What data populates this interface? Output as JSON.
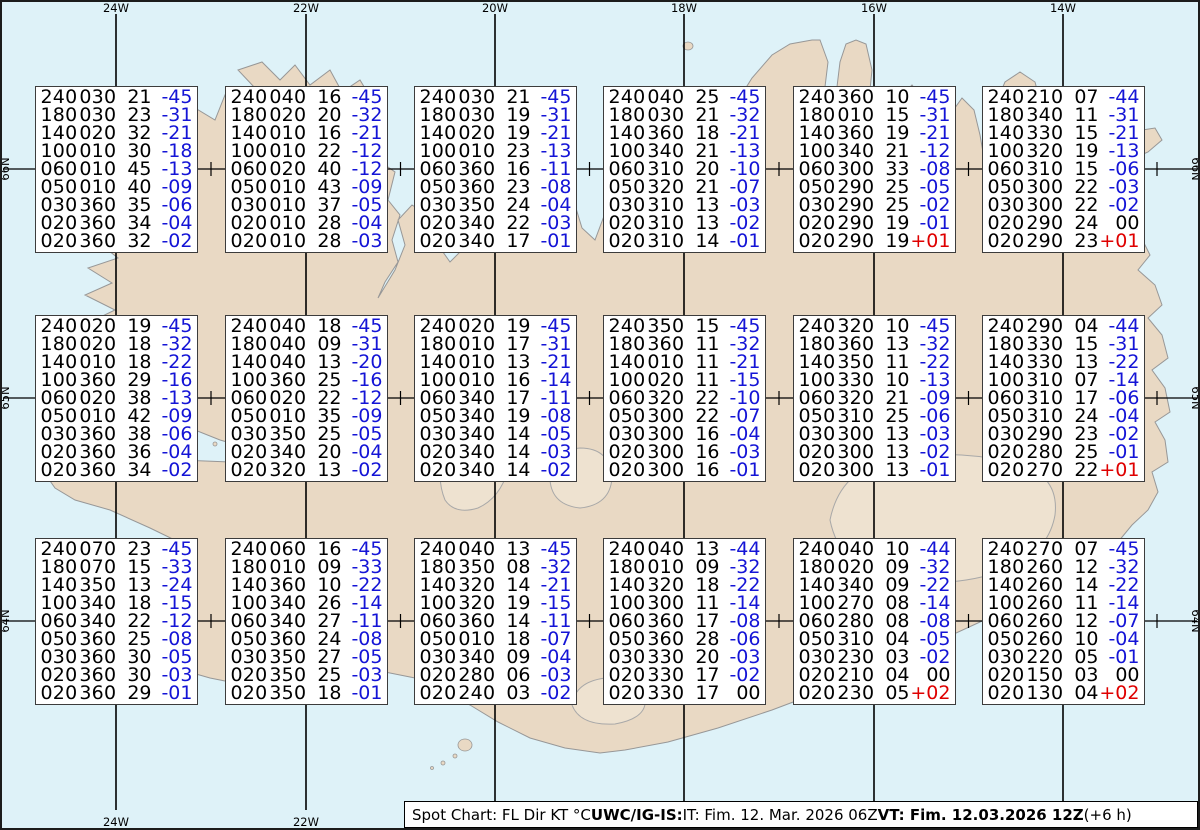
{
  "chart_title": "Spot Chart Iceland upper winds and temperatures",
  "colors": {
    "ocean": "#def2f8",
    "land": "#e9d9c4",
    "coast": "#979797",
    "glacier_line": "#a8a8a8",
    "grid": "#000000",
    "temp_negative": "#1414d6",
    "temp_positive": "#df0000",
    "temp_zero": "#000000",
    "box_background": "#ffffff",
    "box_border": "#3c3c3c"
  },
  "grid": {
    "meridians": [
      {
        "label": "24W",
        "x": 116
      },
      {
        "label": "22W",
        "x": 306
      },
      {
        "label": "20W",
        "x": 495
      },
      {
        "label": "18W",
        "x": 684
      },
      {
        "label": "16W",
        "x": 874
      },
      {
        "label": "14W",
        "x": 1063
      }
    ],
    "parallels": [
      {
        "label": "66N",
        "y": 169
      },
      {
        "label": "65N",
        "y": 398
      },
      {
        "label": "64N",
        "y": 621
      }
    ]
  },
  "caption": {
    "segments": [
      {
        "text": "Spot Chart: FL Dir KT °C ",
        "bold": false
      },
      {
        "text": "UWC/IG-IS:",
        "bold": true
      },
      {
        "text": " IT: Fim. 12. Mar. 2026 06Z ",
        "bold": false
      },
      {
        "text": "VT: Fim. 12.03.2026 12Z",
        "bold": true
      },
      {
        "text": " (+6 h)",
        "bold": false
      }
    ]
  },
  "boxes": [
    {
      "r": 0,
      "c": 0,
      "lines": [
        [
          "240030",
          "21",
          "-45"
        ],
        [
          "180030",
          "23",
          "-31"
        ],
        [
          "140020",
          "32",
          "-21"
        ],
        [
          "100010",
          "30",
          "-18"
        ],
        [
          "060010",
          "45",
          "-13"
        ],
        [
          "050010",
          "40",
          "-09"
        ],
        [
          "030360",
          "35",
          "-06"
        ],
        [
          "020360",
          "34",
          "-04"
        ],
        [
          "020360",
          "32",
          "-02"
        ]
      ]
    },
    {
      "r": 0,
      "c": 1,
      "lines": [
        [
          "240040",
          "16",
          "-45"
        ],
        [
          "180020",
          "20",
          "-32"
        ],
        [
          "140010",
          "16",
          "-21"
        ],
        [
          "100010",
          "22",
          "-12"
        ],
        [
          "060020",
          "40",
          "-12"
        ],
        [
          "050010",
          "43",
          "-09"
        ],
        [
          "030010",
          "37",
          "-05"
        ],
        [
          "020010",
          "28",
          "-04"
        ],
        [
          "020010",
          "28",
          "-03"
        ]
      ]
    },
    {
      "r": 0,
      "c": 2,
      "lines": [
        [
          "240030",
          "21",
          "-45"
        ],
        [
          "180030",
          "19",
          "-31"
        ],
        [
          "140020",
          "19",
          "-21"
        ],
        [
          "100010",
          "23",
          "-13"
        ],
        [
          "060360",
          "16",
          "-11"
        ],
        [
          "050360",
          "23",
          "-08"
        ],
        [
          "030350",
          "24",
          "-04"
        ],
        [
          "020340",
          "22",
          "-03"
        ],
        [
          "020340",
          "17",
          "-01"
        ]
      ]
    },
    {
      "r": 0,
      "c": 3,
      "lines": [
        [
          "240040",
          "25",
          "-45"
        ],
        [
          "180030",
          "21",
          "-32"
        ],
        [
          "140360",
          "18",
          "-21"
        ],
        [
          "100340",
          "21",
          "-13"
        ],
        [
          "060310",
          "20",
          "-10"
        ],
        [
          "050320",
          "21",
          "-07"
        ],
        [
          "030310",
          "13",
          "-03"
        ],
        [
          "020310",
          "13",
          "-02"
        ],
        [
          "020310",
          "14",
          "-01"
        ]
      ]
    },
    {
      "r": 0,
      "c": 4,
      "lines": [
        [
          "240360",
          "10",
          "-45"
        ],
        [
          "180010",
          "15",
          "-31"
        ],
        [
          "140360",
          "19",
          "-21"
        ],
        [
          "100340",
          "21",
          "-12"
        ],
        [
          "060300",
          "33",
          "-08"
        ],
        [
          "050290",
          "25",
          "-05"
        ],
        [
          "030290",
          "25",
          "-02"
        ],
        [
          "020290",
          "19",
          "-01"
        ],
        [
          "020290",
          "19",
          "+01"
        ]
      ]
    },
    {
      "r": 0,
      "c": 5,
      "lines": [
        [
          "240210",
          "07",
          "-44"
        ],
        [
          "180340",
          "11",
          "-31"
        ],
        [
          "140330",
          "15",
          "-21"
        ],
        [
          "100320",
          "19",
          "-13"
        ],
        [
          "060310",
          "15",
          "-06"
        ],
        [
          "050300",
          "22",
          "-03"
        ],
        [
          "030300",
          "22",
          "-02"
        ],
        [
          "020290",
          "24",
          "00"
        ],
        [
          "020290",
          "23",
          "+01"
        ]
      ]
    },
    {
      "r": 1,
      "c": 0,
      "lines": [
        [
          "240020",
          "19",
          "-45"
        ],
        [
          "180020",
          "18",
          "-32"
        ],
        [
          "140010",
          "18",
          "-22"
        ],
        [
          "100360",
          "29",
          "-16"
        ],
        [
          "060020",
          "38",
          "-13"
        ],
        [
          "050010",
          "42",
          "-09"
        ],
        [
          "030360",
          "38",
          "-06"
        ],
        [
          "020360",
          "36",
          "-04"
        ],
        [
          "020360",
          "34",
          "-02"
        ]
      ]
    },
    {
      "r": 1,
      "c": 1,
      "lines": [
        [
          "240040",
          "18",
          "-45"
        ],
        [
          "180040",
          "09",
          "-31"
        ],
        [
          "140040",
          "13",
          "-20"
        ],
        [
          "100360",
          "25",
          "-16"
        ],
        [
          "060020",
          "22",
          "-12"
        ],
        [
          "050010",
          "35",
          "-09"
        ],
        [
          "030350",
          "25",
          "-05"
        ],
        [
          "020340",
          "20",
          "-04"
        ],
        [
          "020320",
          "13",
          "-02"
        ]
      ]
    },
    {
      "r": 1,
      "c": 2,
      "lines": [
        [
          "240020",
          "19",
          "-45"
        ],
        [
          "180010",
          "17",
          "-31"
        ],
        [
          "140010",
          "13",
          "-21"
        ],
        [
          "100010",
          "16",
          "-14"
        ],
        [
          "060340",
          "17",
          "-11"
        ],
        [
          "050340",
          "19",
          "-08"
        ],
        [
          "030340",
          "14",
          "-05"
        ],
        [
          "020340",
          "14",
          "-03"
        ],
        [
          "020340",
          "14",
          "-02"
        ]
      ]
    },
    {
      "r": 1,
      "c": 3,
      "lines": [
        [
          "240350",
          "15",
          "-45"
        ],
        [
          "180360",
          "11",
          "-32"
        ],
        [
          "140010",
          "11",
          "-21"
        ],
        [
          "100020",
          "11",
          "-15"
        ],
        [
          "060320",
          "22",
          "-10"
        ],
        [
          "050300",
          "22",
          "-07"
        ],
        [
          "030300",
          "16",
          "-04"
        ],
        [
          "020300",
          "16",
          "-03"
        ],
        [
          "020300",
          "16",
          "-01"
        ]
      ]
    },
    {
      "r": 1,
      "c": 4,
      "lines": [
        [
          "240320",
          "10",
          "-45"
        ],
        [
          "180360",
          "13",
          "-32"
        ],
        [
          "140350",
          "11",
          "-22"
        ],
        [
          "100330",
          "10",
          "-13"
        ],
        [
          "060320",
          "21",
          "-09"
        ],
        [
          "050310",
          "25",
          "-06"
        ],
        [
          "030300",
          "13",
          "-03"
        ],
        [
          "020300",
          "13",
          "-02"
        ],
        [
          "020300",
          "13",
          "-01"
        ]
      ]
    },
    {
      "r": 1,
      "c": 5,
      "lines": [
        [
          "240290",
          "04",
          "-44"
        ],
        [
          "180330",
          "15",
          "-31"
        ],
        [
          "140330",
          "13",
          "-22"
        ],
        [
          "100310",
          "07",
          "-14"
        ],
        [
          "060310",
          "17",
          "-06"
        ],
        [
          "050310",
          "24",
          "-04"
        ],
        [
          "030290",
          "23",
          "-02"
        ],
        [
          "020280",
          "25",
          "-01"
        ],
        [
          "020270",
          "22",
          "+01"
        ]
      ]
    },
    {
      "r": 2,
      "c": 0,
      "lines": [
        [
          "240070",
          "23",
          "-45"
        ],
        [
          "180070",
          "15",
          "-33"
        ],
        [
          "140350",
          "13",
          "-24"
        ],
        [
          "100340",
          "18",
          "-15"
        ],
        [
          "060340",
          "22",
          "-12"
        ],
        [
          "050360",
          "25",
          "-08"
        ],
        [
          "030360",
          "30",
          "-05"
        ],
        [
          "020360",
          "30",
          "-03"
        ],
        [
          "020360",
          "29",
          "-01"
        ]
      ]
    },
    {
      "r": 2,
      "c": 1,
      "lines": [
        [
          "240060",
          "16",
          "-45"
        ],
        [
          "180010",
          "09",
          "-33"
        ],
        [
          "140360",
          "10",
          "-22"
        ],
        [
          "100340",
          "26",
          "-14"
        ],
        [
          "060340",
          "27",
          "-11"
        ],
        [
          "050360",
          "24",
          "-08"
        ],
        [
          "030350",
          "27",
          "-05"
        ],
        [
          "020350",
          "25",
          "-03"
        ],
        [
          "020350",
          "18",
          "-01"
        ]
      ]
    },
    {
      "r": 2,
      "c": 2,
      "lines": [
        [
          "240040",
          "13",
          "-45"
        ],
        [
          "180350",
          "08",
          "-32"
        ],
        [
          "140320",
          "14",
          "-21"
        ],
        [
          "100320",
          "19",
          "-15"
        ],
        [
          "060360",
          "14",
          "-11"
        ],
        [
          "050010",
          "18",
          "-07"
        ],
        [
          "030340",
          "09",
          "-04"
        ],
        [
          "020280",
          "06",
          "-03"
        ],
        [
          "020240",
          "03",
          "-02"
        ]
      ]
    },
    {
      "r": 2,
      "c": 3,
      "lines": [
        [
          "240040",
          "13",
          "-44"
        ],
        [
          "180010",
          "09",
          "-32"
        ],
        [
          "140320",
          "18",
          "-22"
        ],
        [
          "100300",
          "11",
          "-14"
        ],
        [
          "060360",
          "17",
          "-08"
        ],
        [
          "050360",
          "28",
          "-06"
        ],
        [
          "030330",
          "20",
          "-03"
        ],
        [
          "020330",
          "17",
          "-02"
        ],
        [
          "020330",
          "17",
          "00"
        ]
      ]
    },
    {
      "r": 2,
      "c": 4,
      "lines": [
        [
          "240040",
          "10",
          "-44"
        ],
        [
          "180020",
          "09",
          "-32"
        ],
        [
          "140340",
          "09",
          "-22"
        ],
        [
          "100270",
          "08",
          "-14"
        ],
        [
          "060280",
          "08",
          "-08"
        ],
        [
          "050310",
          "04",
          "-05"
        ],
        [
          "030230",
          "03",
          "-02"
        ],
        [
          "020210",
          "04",
          "00"
        ],
        [
          "020230",
          "05",
          "+02"
        ]
      ]
    },
    {
      "r": 2,
      "c": 5,
      "lines": [
        [
          "240270",
          "07",
          "-45"
        ],
        [
          "180260",
          "12",
          "-32"
        ],
        [
          "140260",
          "14",
          "-22"
        ],
        [
          "100260",
          "11",
          "-14"
        ],
        [
          "060260",
          "12",
          "-07"
        ],
        [
          "050260",
          "10",
          "-04"
        ],
        [
          "030220",
          "05",
          "-01"
        ],
        [
          "020150",
          "03",
          "00"
        ],
        [
          "020130",
          "04",
          "+02"
        ]
      ]
    }
  ]
}
